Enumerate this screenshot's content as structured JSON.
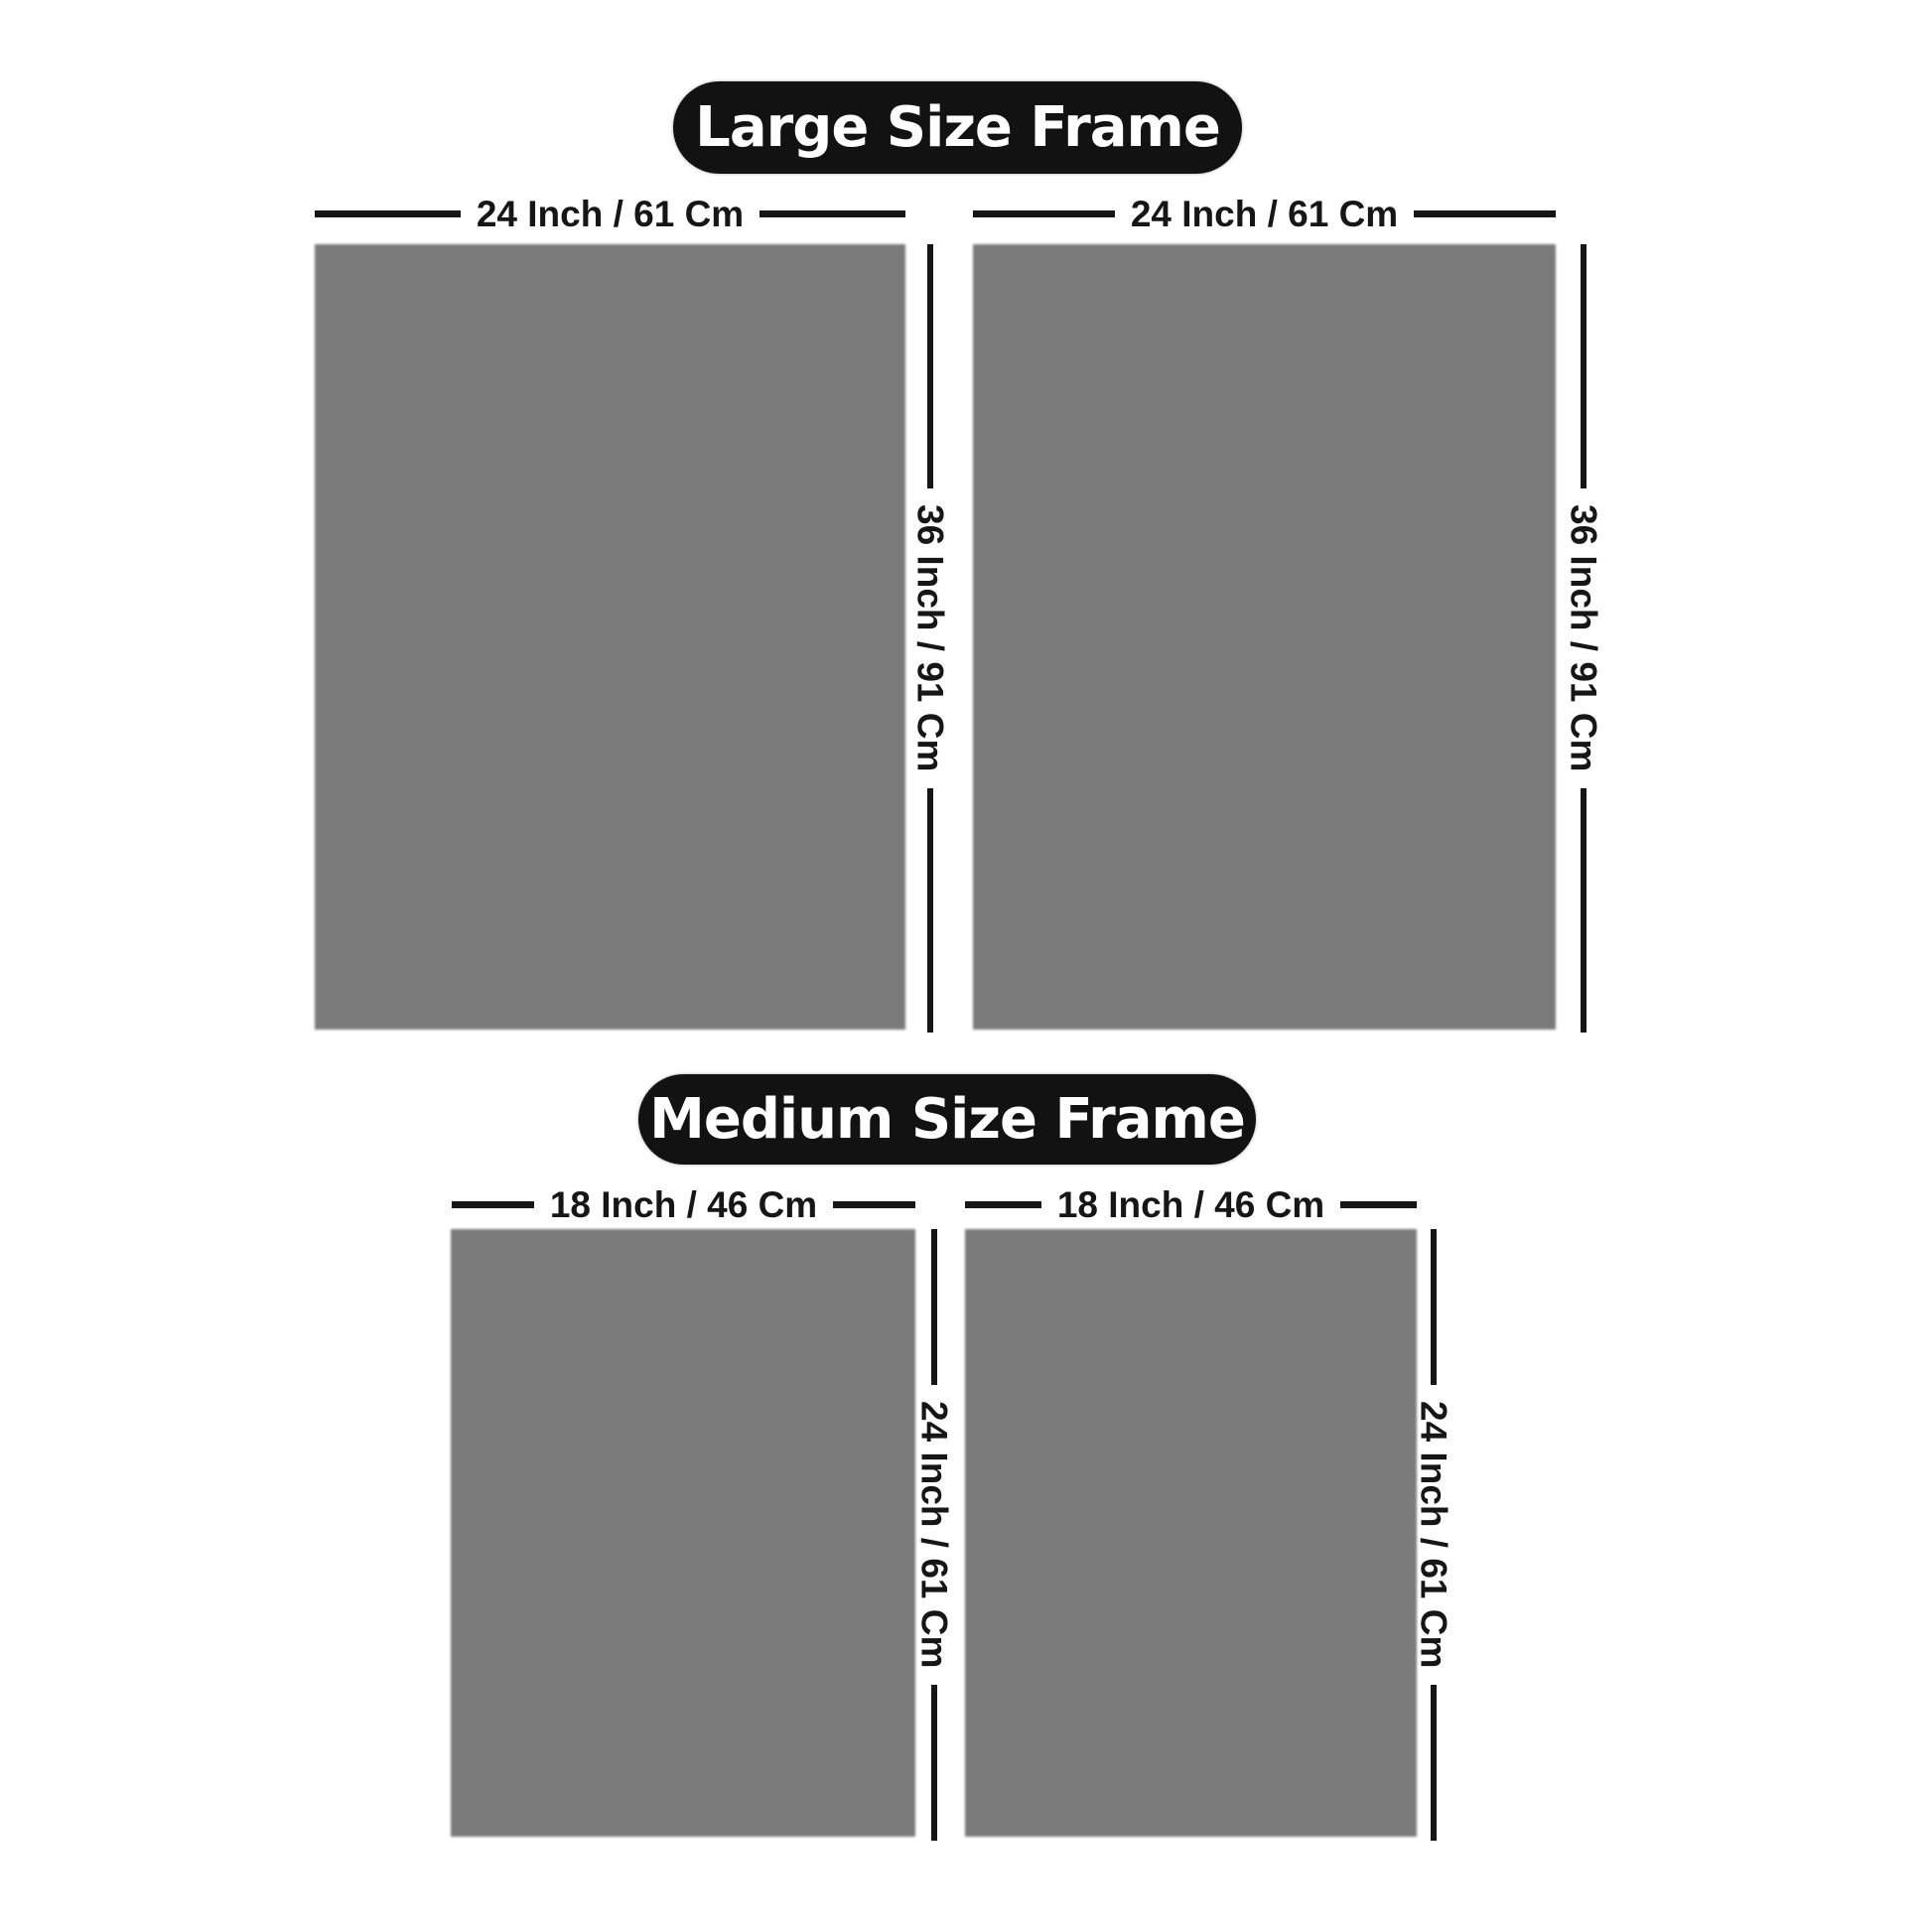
{
  "page": {
    "background": "#ffffff",
    "type": "product-size-guide"
  },
  "colors": {
    "panel_gray": "#7a7a7a",
    "pill_background": "#121212",
    "pill_text": "#ffffff",
    "dimension_line": "#161616",
    "dimension_text": "#161616"
  },
  "sections": [
    {
      "id": "large",
      "title": "Large Size Frame",
      "frame_count": 2,
      "width_label": "24 Inch / 61 Cm",
      "height_label": "36 Inch / 91 Cm"
    },
    {
      "id": "medium",
      "title": "Medium Size Frame",
      "frame_count": 2,
      "width_label": "18 Inch / 46 Cm",
      "height_label": "24 Inch / 61 Cm"
    }
  ]
}
